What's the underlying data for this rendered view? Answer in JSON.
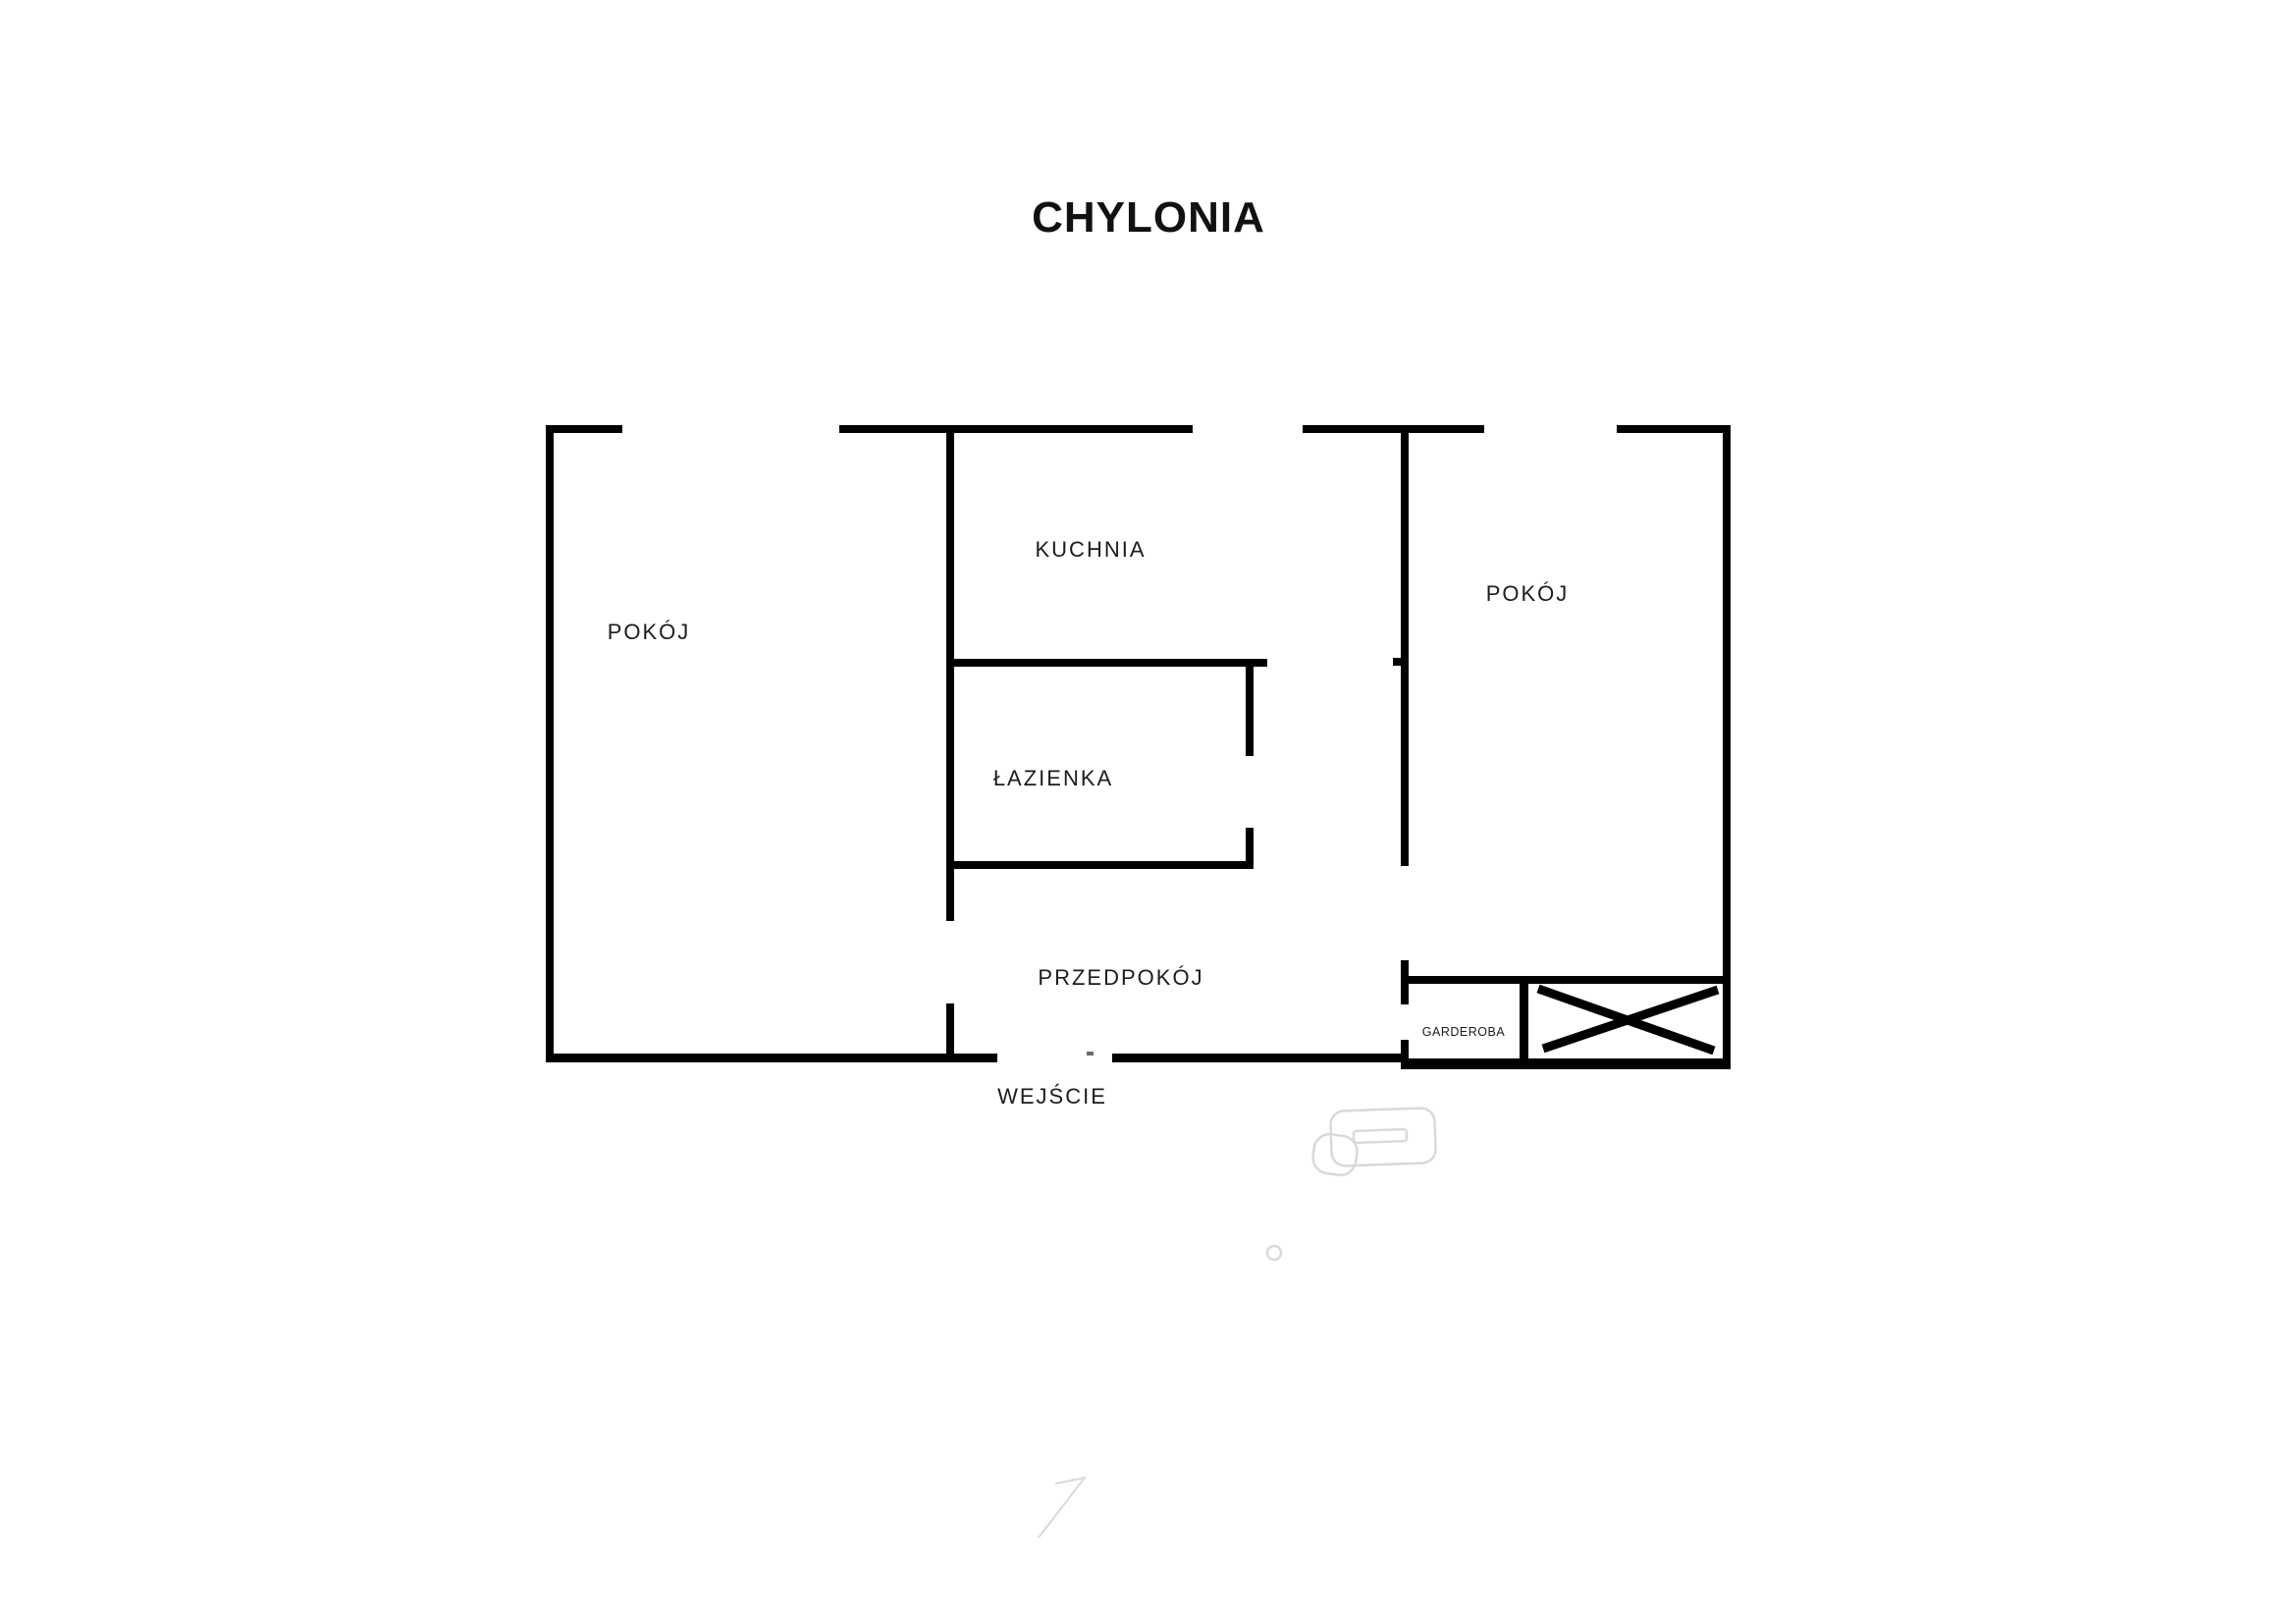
{
  "title": "CHYLONIA",
  "rooms": {
    "room_left": "POKÓJ",
    "kitchen": "KUCHNIA",
    "bathroom": "ŁAZIENKA",
    "room_right": "POKÓJ",
    "hallway": "PRZEDPOKÓJ",
    "wardrobe": "GARDEROBA",
    "entrance": "WEJŚCIE"
  },
  "icons": {
    "wardrobe_symbol": "crossed-rectangle-wardrobe",
    "watermark_shapes": [
      "furniture-outline",
      "small-circle-outline",
      "arrow-7-outline"
    ]
  },
  "colors": {
    "walls": "#000000",
    "labels": "#1c1c1c",
    "watermark": "#d9d9d9",
    "background": "#ffffff"
  }
}
